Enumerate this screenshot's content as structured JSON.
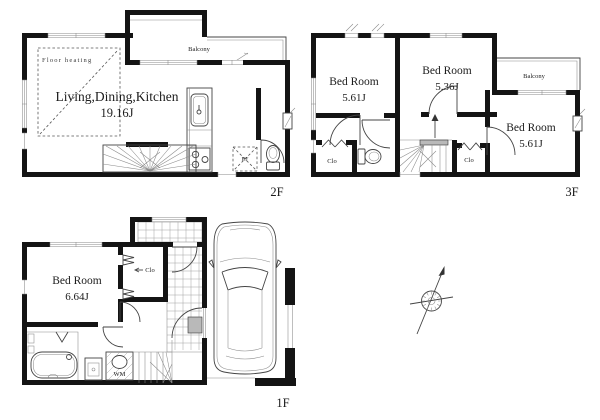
{
  "floors": {
    "f2": {
      "label": "2F",
      "room_label": "Living,Dining,Kitchen",
      "room_area": "19.16J",
      "floor_heating_label": "Floor heating",
      "balcony_label": "Balcony",
      "refrigerator_label": "RF"
    },
    "f3": {
      "label": "3F",
      "bedrooms": [
        {
          "name": "Bed Room",
          "area": "5.61J"
        },
        {
          "name": "Bed Room",
          "area": "5.36J"
        },
        {
          "name": "Bed Room",
          "area": "5.61J"
        }
      ],
      "balcony_label": "Balcony",
      "closet_labels": [
        "Clo",
        "Clo"
      ]
    },
    "f1": {
      "label": "1F",
      "bedroom": {
        "name": "Bed Room",
        "area": "6.64J"
      },
      "closet_label": "Clo",
      "washing_machine_label": "WM"
    }
  },
  "colors": {
    "background": "#ffffff",
    "wall": "#141414",
    "line": "#444444",
    "step_gray": "#b9b9b9",
    "text": "#1c1c1c"
  }
}
